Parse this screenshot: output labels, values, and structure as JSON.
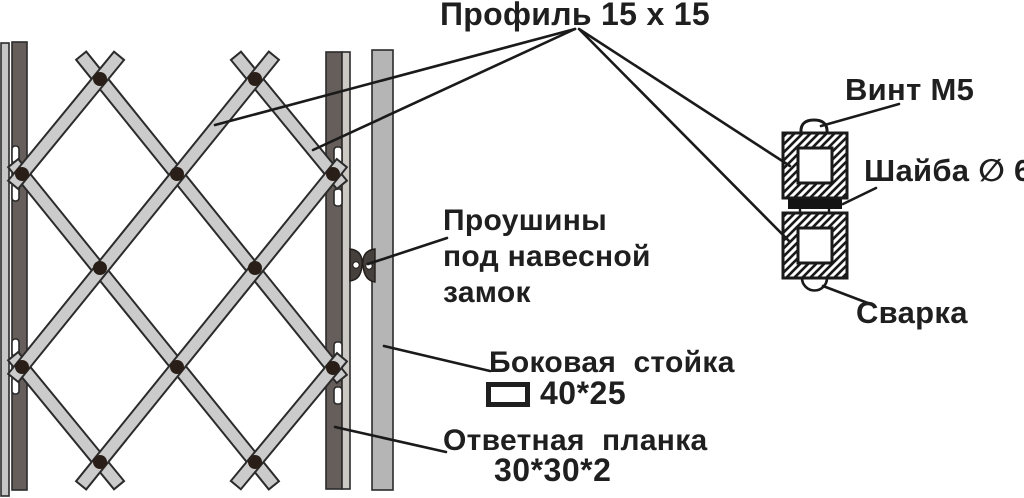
{
  "diagram": {
    "type": "technical-drawing",
    "background": "#ffffff"
  },
  "labels": {
    "profile": "Профиль 15 х 15",
    "screw": "Винт М5",
    "washer": "Шайба ∅ 6",
    "weld": "Сварка",
    "padlock_eyes": "Проушины\nпод навесной\nзамок",
    "side_post": "Боковая  стойка",
    "side_post_size": "40*25",
    "strike_plate": "Ответная  планка",
    "strike_plate_size": "30*30*2"
  },
  "colors": {
    "lattice_bar": "#cbcbcb",
    "dark_post": "#665e5a",
    "left_guide_strip": "#c6c6c6",
    "right_guide_strip": "#ccc8c4",
    "side_post": "#b5b5b5",
    "rivet": "#2a1f18",
    "outline": "#1a1a1a",
    "text": "#1f1f1f",
    "washer": "#141414"
  }
}
